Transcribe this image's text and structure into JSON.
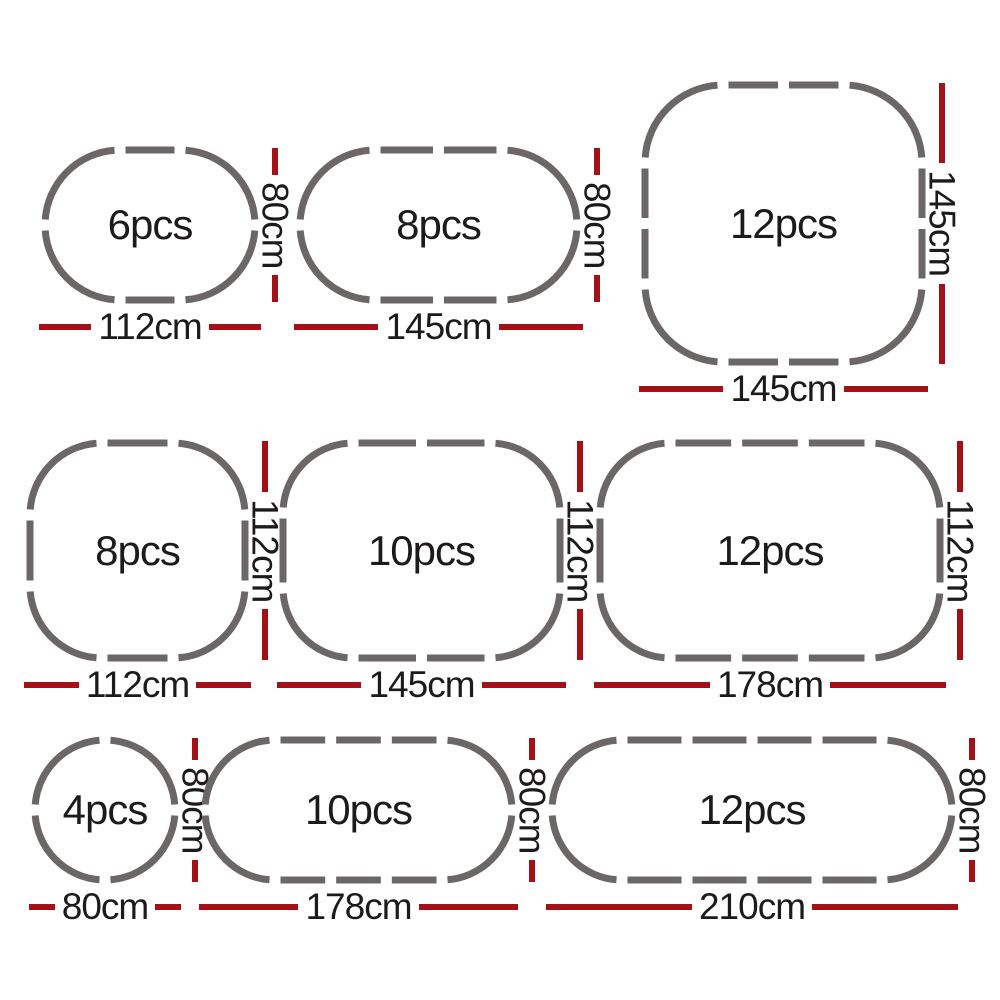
{
  "colors": {
    "track": "#6b6767",
    "dimension": "#a31015",
    "text": "#1c1a1a",
    "background": "#ffffff"
  },
  "shapes": [
    {
      "name": "small-oval",
      "shape_type": "oval",
      "pieces": 6,
      "pieces_label": "6pcs",
      "width_cm": 112,
      "height_cm": 80,
      "width_label": "112cm",
      "height_label": "80cm",
      "track": {
        "w": 210,
        "h": 150,
        "r": 75,
        "top": 1,
        "right": 0,
        "bottom": 1,
        "left": 0
      }
    },
    {
      "name": "medium-oval",
      "shape_type": "oval",
      "pieces": 8,
      "pieces_label": "8pcs",
      "width_cm": 145,
      "height_cm": 80,
      "width_label": "145cm",
      "height_label": "80cm",
      "track": {
        "w": 277,
        "h": 150,
        "r": 75,
        "top": 2,
        "right": 0,
        "bottom": 2,
        "left": 0
      }
    },
    {
      "name": "large-rounded-square",
      "shape_type": "rounded-square",
      "pieces": 12,
      "pieces_label": "12pcs",
      "width_cm": 145,
      "height_cm": 145,
      "width_label": "145cm",
      "height_label": "145cm",
      "track": {
        "w": 277,
        "h": 277,
        "r": 78,
        "top": 2,
        "right": 2,
        "bottom": 2,
        "left": 2
      }
    },
    {
      "name": "small-rounded-square",
      "shape_type": "rounded-square",
      "pieces": 8,
      "pieces_label": "8pcs",
      "width_cm": 112,
      "height_cm": 112,
      "width_label": "112cm",
      "height_label": "112cm",
      "track": {
        "w": 215,
        "h": 215,
        "r": 72,
        "top": 1,
        "right": 1,
        "bottom": 1,
        "left": 1
      }
    },
    {
      "name": "medium-rounded-rectangle",
      "shape_type": "rounded-rectangle",
      "pieces": 10,
      "pieces_label": "10pcs",
      "width_cm": 145,
      "height_cm": 112,
      "width_label": "145cm",
      "height_label": "112cm",
      "track": {
        "w": 277,
        "h": 215,
        "r": 70,
        "top": 2,
        "right": 1,
        "bottom": 2,
        "left": 1
      }
    },
    {
      "name": "large-rounded-rectangle",
      "shape_type": "rounded-rectangle",
      "pieces": 12,
      "pieces_label": "12pcs",
      "width_cm": 178,
      "height_cm": 112,
      "width_label": "178cm",
      "height_label": "112cm",
      "track": {
        "w": 340,
        "h": 215,
        "r": 70,
        "top": 3,
        "right": 1,
        "bottom": 3,
        "left": 1
      }
    },
    {
      "name": "circle",
      "shape_type": "circle",
      "pieces": 4,
      "pieces_label": "4pcs",
      "width_cm": 80,
      "height_cm": 80,
      "width_label": "80cm",
      "height_label": "80cm",
      "track": {
        "w": 140,
        "h": 140,
        "r": 70,
        "top": 0,
        "right": 0,
        "bottom": 0,
        "left": 0
      }
    },
    {
      "name": "long-oval",
      "shape_type": "oval",
      "pieces": 10,
      "pieces_label": "10pcs",
      "width_cm": 178,
      "height_cm": 80,
      "width_label": "178cm",
      "height_label": "80cm",
      "track": {
        "w": 307,
        "h": 140,
        "r": 70,
        "top": 3,
        "right": 0,
        "bottom": 3,
        "left": 0
      }
    },
    {
      "name": "extra-long-oval",
      "shape_type": "oval",
      "pieces": 12,
      "pieces_label": "12pcs",
      "width_cm": 210,
      "height_cm": 80,
      "width_label": "210cm",
      "height_label": "80cm",
      "track": {
        "w": 400,
        "h": 140,
        "r": 70,
        "top": 4,
        "right": 0,
        "bottom": 4,
        "left": 0
      }
    }
  ]
}
